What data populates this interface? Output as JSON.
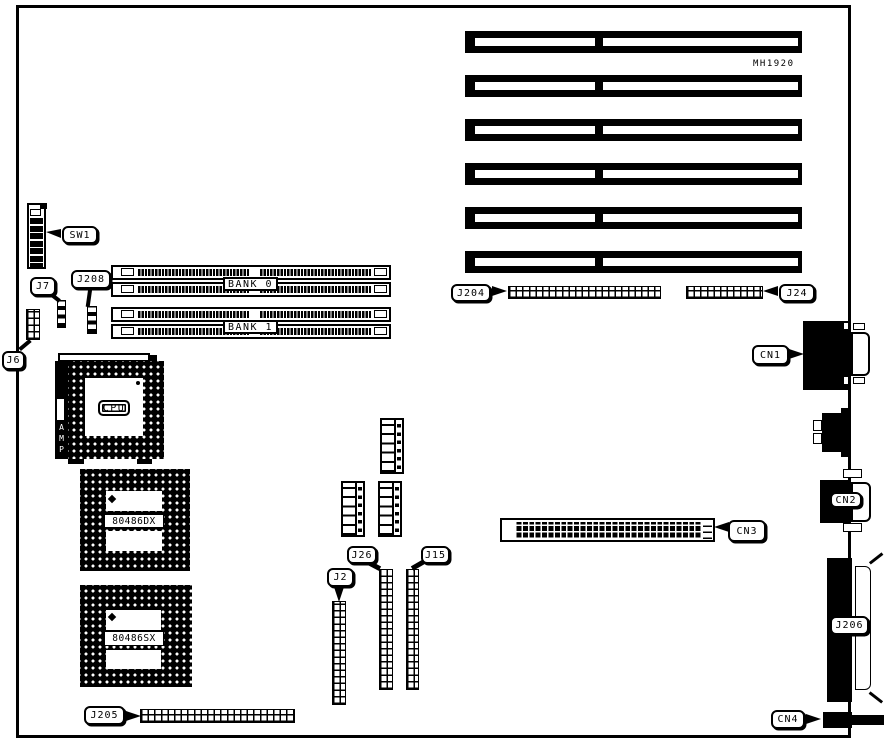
{
  "diagram": {
    "part_number": "MH1920",
    "callouts": {
      "sw1": "SW1",
      "j7": "J7",
      "j208": "J208",
      "j6": "J6",
      "j204": "J204",
      "j24": "J24",
      "cn1": "CN1",
      "cn2": "CN2",
      "cn3": "CN3",
      "cn4": "CN4",
      "j206": "J206",
      "j2": "J2",
      "j26": "J26",
      "j15": "J15",
      "j205": "J205"
    },
    "components": {
      "cpu": "CPU",
      "cpu_socket_brand": "AMP",
      "processor_dx": "80486DX",
      "processor_sx": "80486SX",
      "bank0": "BANK 0",
      "bank1": "BANK 1"
    }
  }
}
